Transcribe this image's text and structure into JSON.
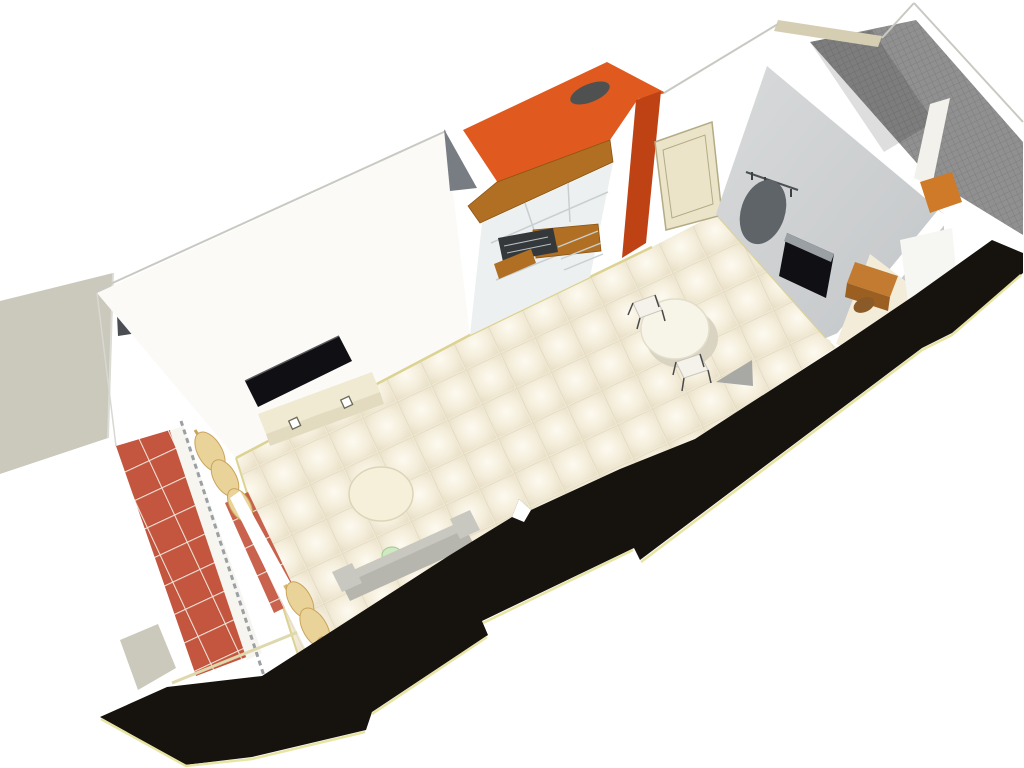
{
  "scene": {
    "kind": "3d-floorplan-aerial-view",
    "objects": [
      {
        "name": "living-room-floor",
        "desc": "cream square tiles"
      },
      {
        "name": "kitchen-niche",
        "desc": "orange accent alcove with dark vent"
      },
      {
        "name": "kitchen-cabinets",
        "desc": "white units with wood countertops and dark cooktop"
      },
      {
        "name": "entry-door",
        "desc": "cream paneled door in top wall"
      },
      {
        "name": "hallway-wall",
        "desc": "gray wall with coat rack and black panel"
      },
      {
        "name": "bathroom-floor",
        "desc": "gray mosaic tiles with orange vanity"
      },
      {
        "name": "desk",
        "desc": "brown desk with chair in right room"
      },
      {
        "name": "dining-table",
        "desc": "round white table with two chairs"
      },
      {
        "name": "sofa",
        "desc": "gray sofa on south wall"
      },
      {
        "name": "rug",
        "desc": "round cream rug"
      },
      {
        "name": "plant-table",
        "desc": "two mint green seats/plants"
      },
      {
        "name": "tv",
        "desc": "black wall screen over cream sideboard"
      },
      {
        "name": "balcony",
        "desc": "red terracotta tiled balcony behind window"
      },
      {
        "name": "curtains",
        "desc": "beige draped curtains along window wall"
      },
      {
        "name": "south-wall",
        "desc": "thick black exterior wall with yellow edge"
      }
    ]
  },
  "colors": {
    "bg": "#ffffff",
    "floor_base": "#f1ead6",
    "floor_line": "#e2d9c0",
    "wall_face": "#fbfaf6",
    "red_tile": "#c0503a",
    "grout": "#efe3d8",
    "orange_bright": "#e0591f",
    "orange_dark": "#bf4214",
    "wood": "#b06f22",
    "wood_dark": "#8a5513",
    "black_wall": "#16130f",
    "wall_gray": "#ced0d2",
    "mosaic": "#909090",
    "mosaic_line": "#7a7a7a",
    "door_cream": "#ebe4c8",
    "door_edge": "#b3ab84",
    "sofa": "#b7b6ae",
    "sofa_light": "#c9c8c0",
    "rug": "#f6f0da",
    "table_white": "#f7f4e8",
    "tv_black": "#101014",
    "sideboard": "#f0ead3",
    "sideboard_front": "#e2dbc0",
    "curtain": "#ead399",
    "curtain_edge": "#c9a45c",
    "baseboard_yellow": "#dcd292",
    "outer_yellow": "#e8e4a2",
    "balcony_gray": "#cbc8bc",
    "hatch_dark": "#4a4e52",
    "plant_green": "#cfe9c0",
    "plant_edge": "#9fc791",
    "desk_brown": "#c27b30",
    "desk_front": "#9c5f22",
    "chair_wood": "#8a5a28",
    "vanity_orange": "#cf7a28",
    "panel_frame": "#9aa0a4",
    "coat_gray": "#5f6468",
    "wedge_gray": "#a8a8a4",
    "end_cap_gray": "#787d84",
    "cabinet_face": "#edf0f0",
    "cooktop": "#34383a",
    "vent_dark": "#4f5150",
    "divider_white": "#f2f1ec",
    "gap_floor": "#f3ecd8",
    "outline_gray": "#c9c9c3"
  }
}
